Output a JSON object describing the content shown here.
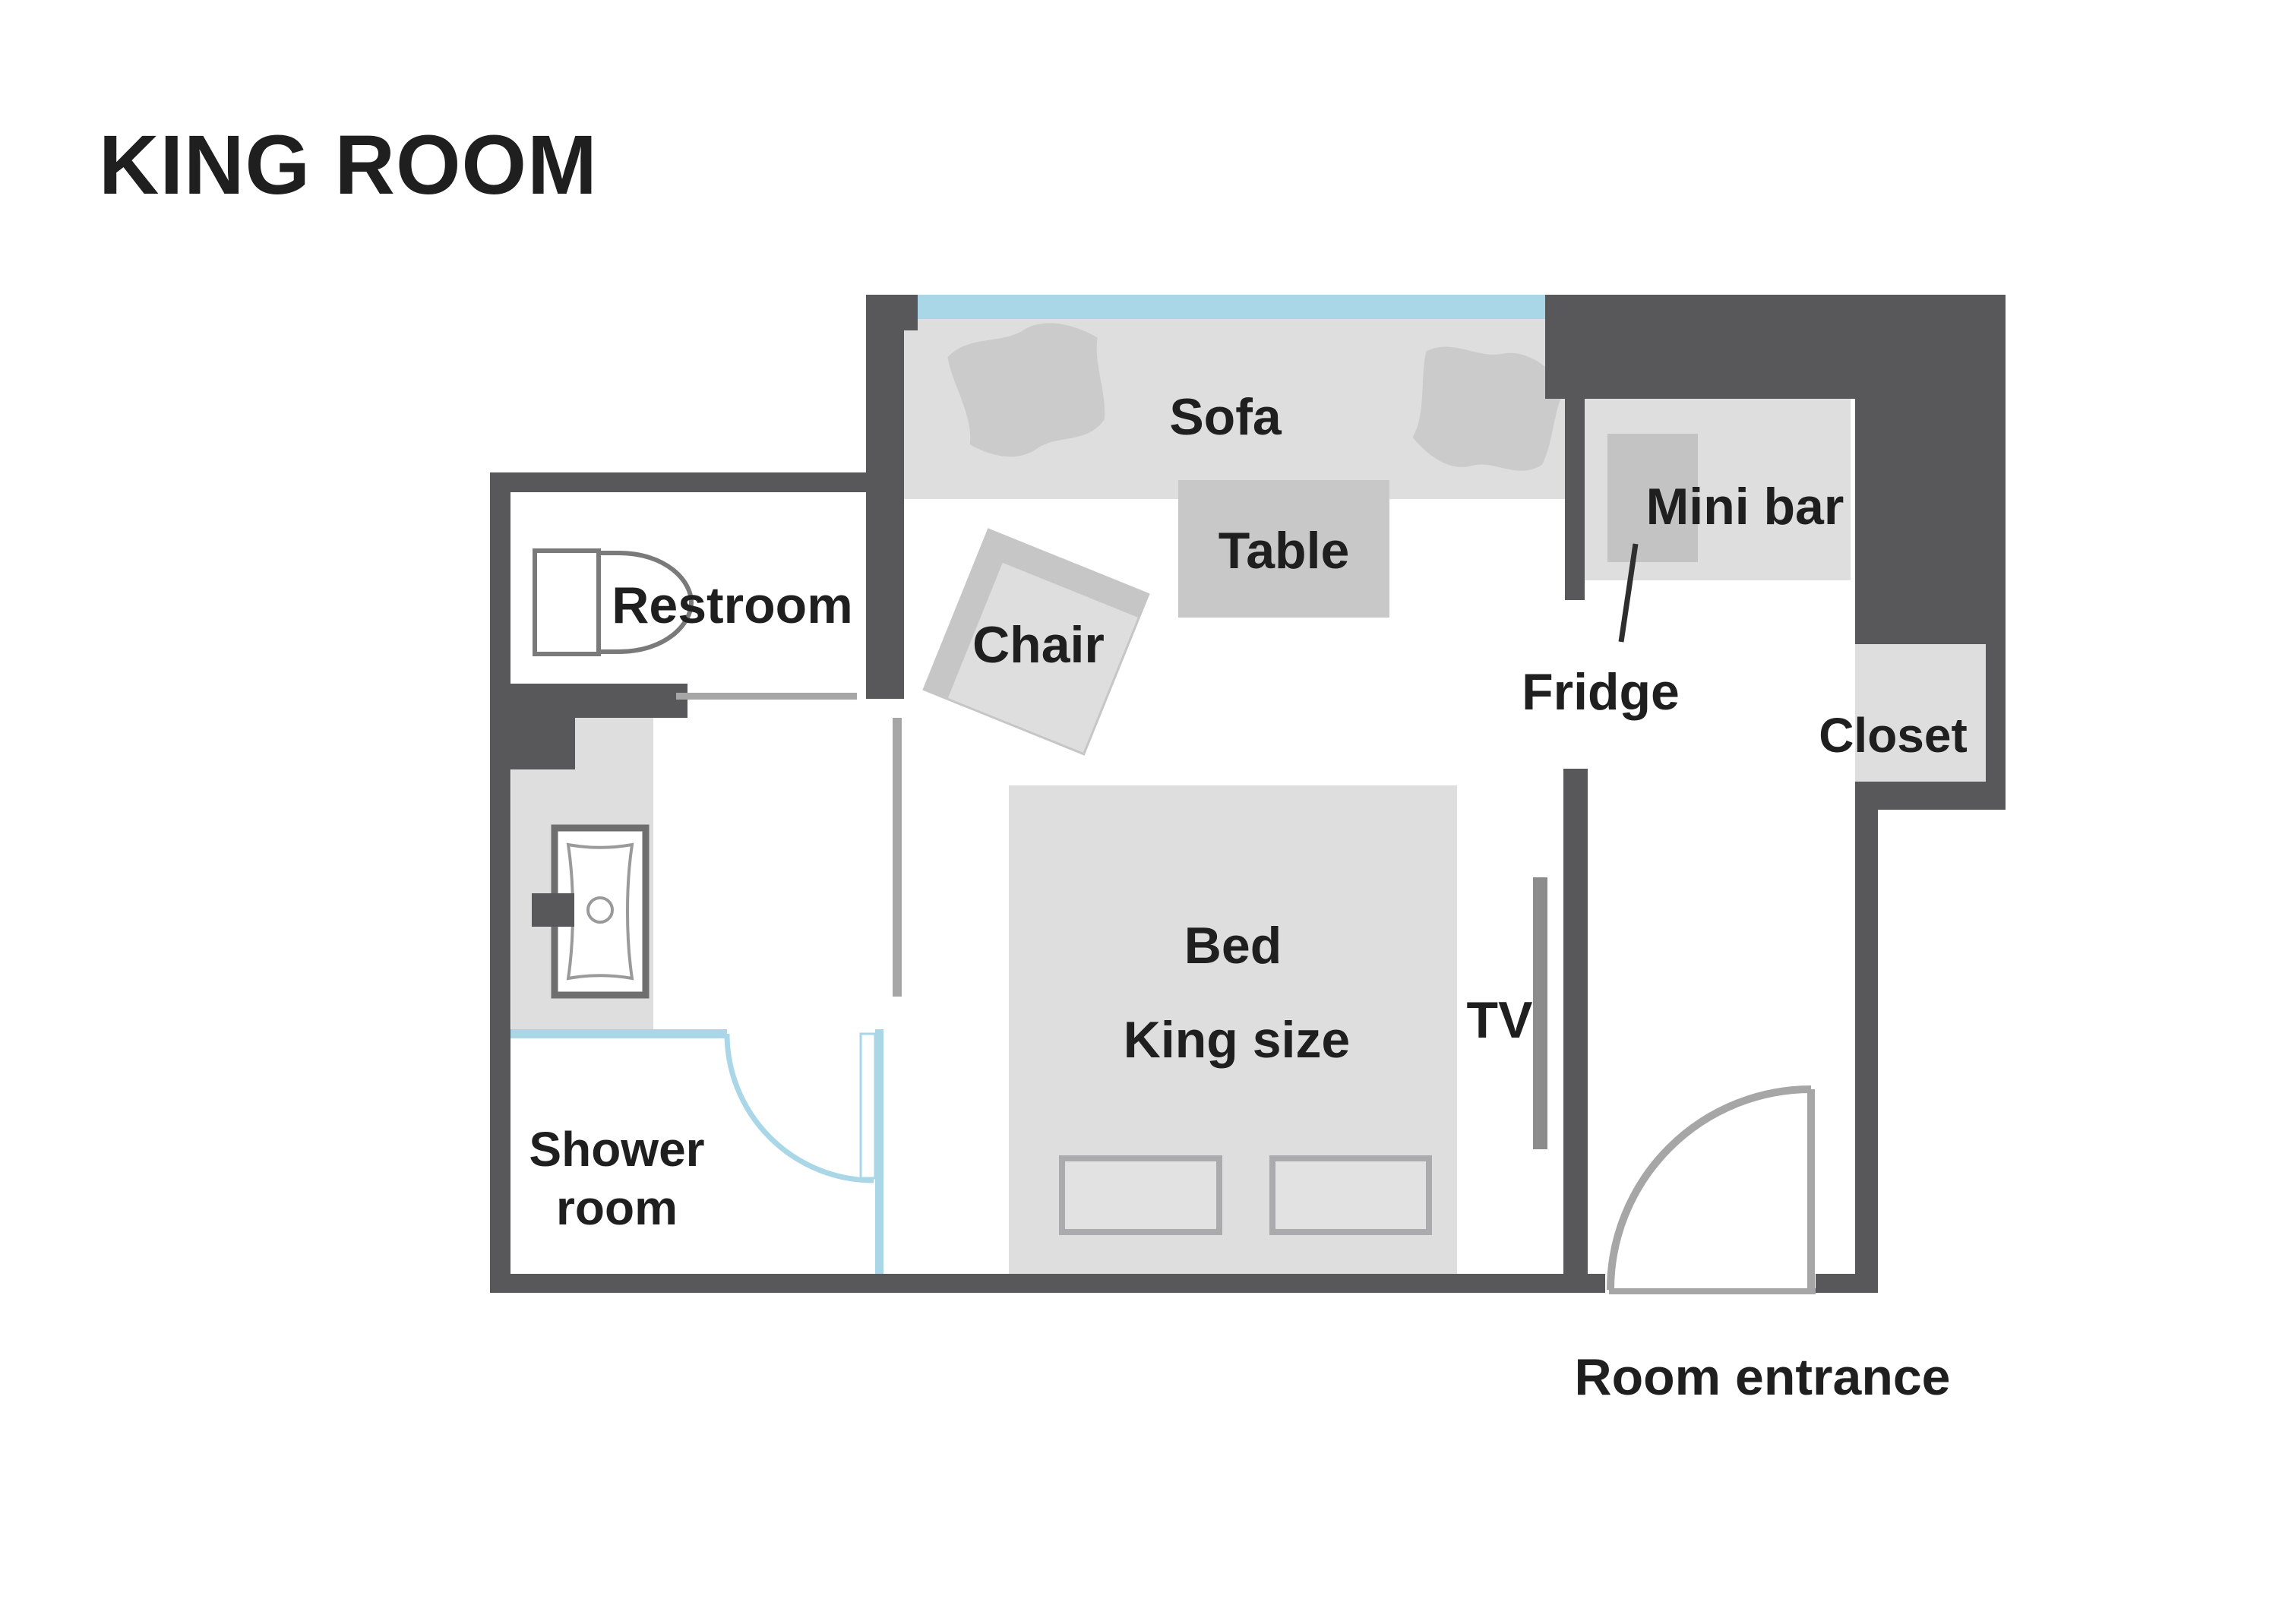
{
  "title": "KING ROOM",
  "labels": {
    "sofa": "Sofa",
    "table": "Table",
    "chair": "Chair",
    "restroom": "Restroom",
    "shower_line1": "Shower",
    "shower_line2": "room",
    "bed_line1": "Bed",
    "bed_line2": "King size",
    "tv": "TV",
    "mini_bar": "Mini bar",
    "fridge": "Fridge",
    "closet": "Closet",
    "room_entrance": "Room entrance"
  },
  "colors": {
    "wall": "#58585a",
    "furniture_light": "#dedede",
    "furniture_mid": "#c8c8c9",
    "cushion": "#cbcbcc",
    "glass_blue": "#a9d7e8",
    "door_gray": "#a6a6a7",
    "tv_gray": "#8c8c8d",
    "text": "#1f1f1f",
    "background": "#ffffff"
  }
}
